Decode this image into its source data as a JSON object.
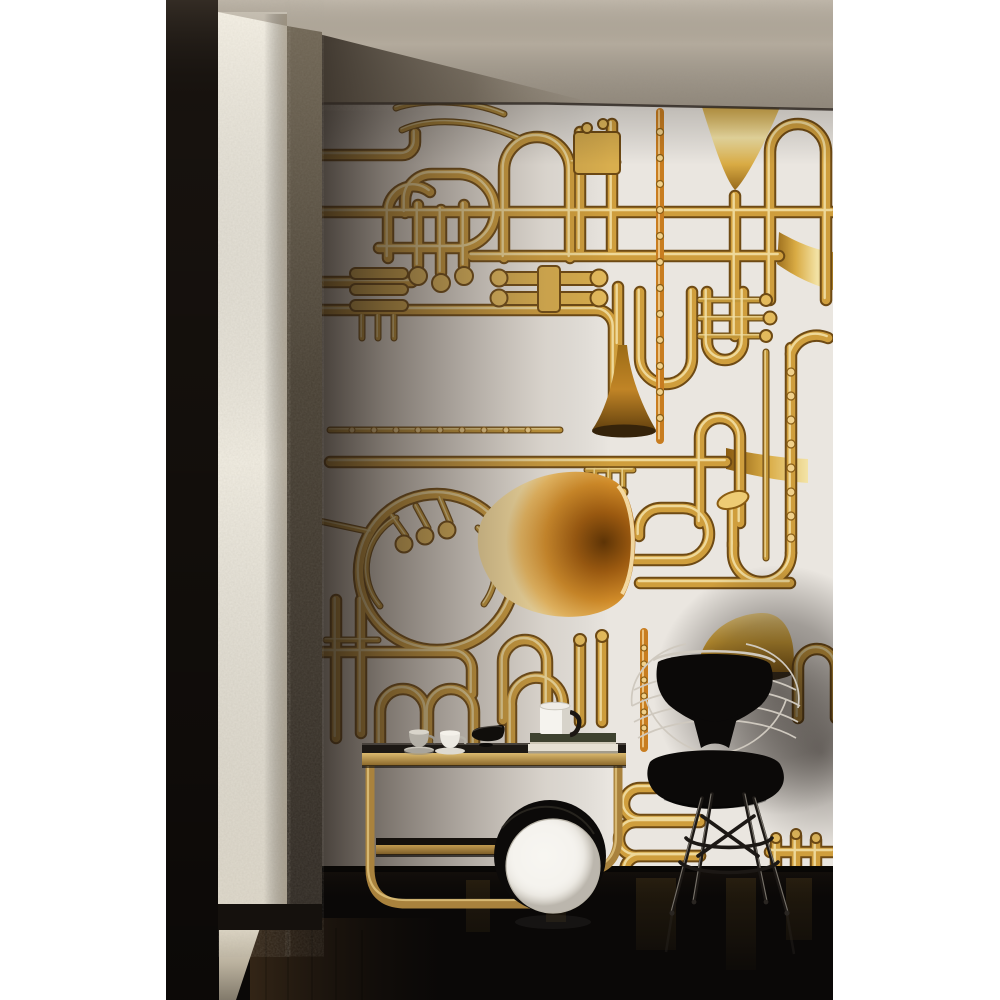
{
  "image": {
    "type": "interior-photograph",
    "description": "Sunlit room corner: wallpaper collaged with golden brass instruments, a rough white plaster column with dark door edge at left, concrete ceiling, glossy black floor; an Artek-style birch tea trolley with cups, a black bowl, books and a white mug; a large white disc wheel; a black wire bikini-pad chair on an Eiffel base casting a soft shadow on the wall",
    "wallpaper_motifs": [
      "trumpet",
      "french-horn",
      "trombone-loops",
      "saxophone",
      "flute",
      "clarinet",
      "tuba-bell",
      "valve-clusters",
      "tubing-loops"
    ],
    "furniture": [
      "tea-trolley",
      "wire-chair",
      "disc-wheel-lamp"
    ],
    "tabletop_items": [
      "gray-espresso-cup",
      "white-espresso-cup",
      "black-bowl",
      "book-stack",
      "white-mug"
    ]
  },
  "colors": {
    "page_bg": "#ffffff",
    "ceiling": "#b3aa9c",
    "wallpaper": "#eae6e0",
    "wall_shadow": "#2a221b",
    "brass": "#cf9e3d",
    "brass_dark": "#6e4a14",
    "brass_highlight": "#f6e7b0",
    "orange_brass": "#c87d20",
    "horn_bell": "#d08022",
    "column": "#f2eee3",
    "column_side": "#57503f",
    "door_dark": "#17120e",
    "floor": "#0a0807",
    "floor_brown": "#2b2015",
    "light_patch": "#ddd6c5",
    "trolley_wood": "#a9823d",
    "trolley_top": "#1c1814",
    "lamp_white": "#f5f3ee",
    "chair_black": "#0b0908",
    "chair_wire": "#cfc9bf",
    "cup_gray": "#b3afa6",
    "cup_white": "#ebe8e1",
    "bowl_black": "#100e0b",
    "book_olive": "#3e4230",
    "book_pages": "#e6e1d4"
  }
}
